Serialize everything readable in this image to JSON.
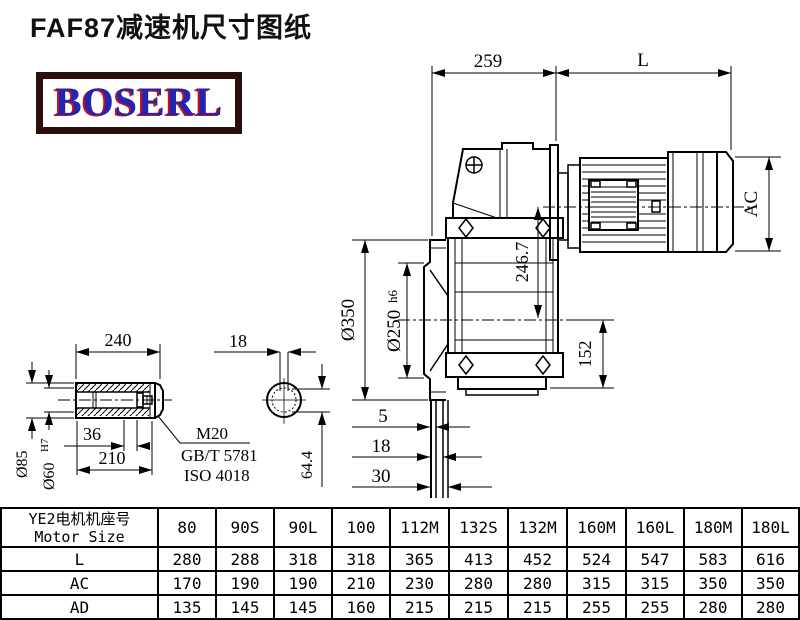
{
  "title": "FAF87减速机尺寸图纸",
  "logo": "BOSERL",
  "accent_colors": {
    "logo_text": "#2323b4",
    "logo_shadow": "#c41212",
    "logo_border": "#2b0f0a",
    "line": "#000000"
  },
  "dims": {
    "top_width": "259",
    "motor_length": "L",
    "motor_diameter": "AC",
    "axis_height": "246.7",
    "flange_od": "Ø350",
    "spigot_d": "Ø250",
    "spigot_tol": "h6",
    "foot_height": "152",
    "gap_5": "5",
    "gap_18": "18",
    "gap_30": "30",
    "shaft_len": "240",
    "key_width": "18",
    "shaft_od": "Ø85",
    "bore_d": "Ø60",
    "bore_tol": "H7",
    "bolt_len": "36",
    "hub_len": "210",
    "bolt": "M20",
    "std_gb": "GB/T 5781",
    "std_iso": "ISO 4018",
    "key_depth": "64.4"
  },
  "table": {
    "header_cn": "YE2电机机座号",
    "header_en": "Motor Size",
    "columns": [
      "80",
      "90S",
      "90L",
      "100",
      "112M",
      "132S",
      "132M",
      "160M",
      "160L",
      "180M",
      "180L"
    ],
    "rows": [
      {
        "label": "L",
        "values": [
          280,
          288,
          318,
          318,
          365,
          413,
          452,
          524,
          547,
          583,
          616
        ]
      },
      {
        "label": "AC",
        "values": [
          170,
          190,
          190,
          210,
          230,
          280,
          280,
          315,
          315,
          350,
          350
        ]
      },
      {
        "label": "AD",
        "values": [
          135,
          145,
          145,
          160,
          215,
          215,
          215,
          255,
          255,
          280,
          280
        ]
      }
    ]
  }
}
